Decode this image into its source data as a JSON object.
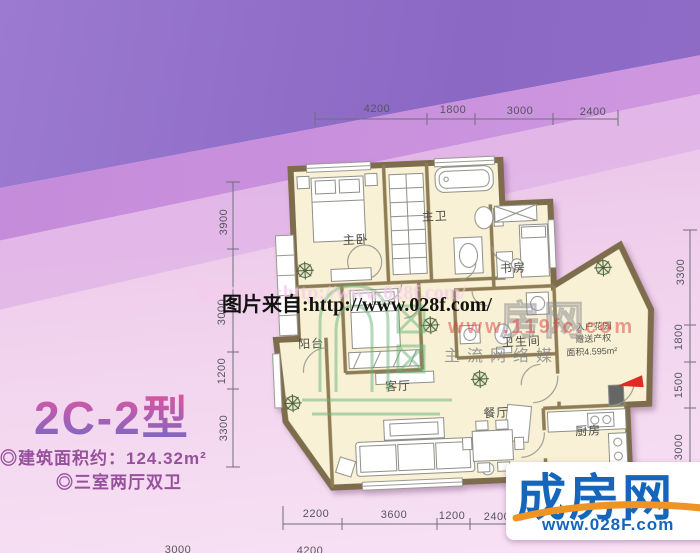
{
  "plan": {
    "title": "2C-2型",
    "area_line": "◎建筑面积约：124.32m²",
    "layout_line": "◎三室两厅双卫",
    "rooms": {
      "master_bedroom": "主卧",
      "master_bath": "主卫",
      "study": "书房",
      "bathroom": "卫生间",
      "balcony": "阳台",
      "living": "客厅",
      "dining": "餐厅",
      "kitchen": "厨房",
      "garden_l1": "入户花园",
      "garden_l2": "赠送产权",
      "garden_l3": "面积4.595m²"
    }
  },
  "dims": {
    "top": [
      "4200",
      "1800",
      "3000",
      "2400"
    ],
    "left": [
      "3900",
      "3000",
      "1200",
      "3300"
    ],
    "right": [
      "3300",
      "1800",
      "1500",
      "3000"
    ],
    "bottom": [
      "2200",
      "3600",
      "1200",
      "2400"
    ],
    "bottom_far": [
      "3000",
      "4200"
    ]
  },
  "watermarks": {
    "ghost": "图片来自:http://www.028f.com/",
    "main": "图片来自:http://www.028f.com/",
    "red": "www.119fc.com",
    "grey": "主流网络媒",
    "outline": "房网"
  },
  "logo": {
    "name": "成房网",
    "url": "www.028F.com"
  },
  "colors": {
    "accent_blue": "#1565bb",
    "swoosh_orange": "#ef9322",
    "arrow_red": "#df2b24",
    "wall_tan": "#7d6d4c",
    "floor_cream": "#f8f1d6"
  }
}
